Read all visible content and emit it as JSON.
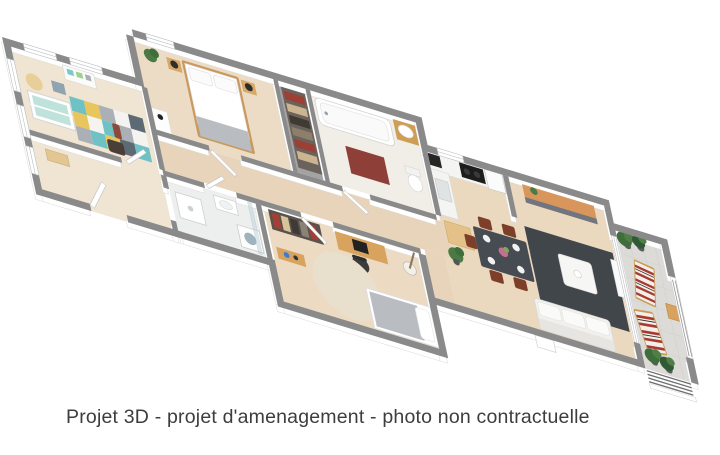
{
  "caption": {
    "text": "Projet 3D - projet d'amenagement - photo non contractuelle"
  },
  "palette": {
    "background": "#ffffff",
    "wall_top": "#8a8a8a",
    "wall_face": "#ffffff",
    "wood_floor": "#ead8bf",
    "wood_floor_light": "#f0e4d2",
    "terrace_tile": "#dcdbd7",
    "bath_tile": "#f1eee8",
    "closet_floor": "#a3a3a3",
    "accent_wood": "#d8a35f",
    "bed_wood": "#c9995e",
    "living_rug": "#41464b",
    "dining_table": "#474c52",
    "chair_brown": "#7e3f2a",
    "bath_mat_red": "#8e4038",
    "deck_stripe_red": "#a83a33",
    "kids_teal": "#6ec1c4",
    "kids_yellow": "#e9c55e",
    "plant_green": "#3f6d3c",
    "caption_text": "#3d3d3d"
  },
  "rooms": [
    "children-room",
    "entry-hall",
    "master-bedroom",
    "closet",
    "bathroom",
    "hallway",
    "shower-room",
    "bedroom-2",
    "kitchen",
    "dining-area",
    "living-room",
    "terrace"
  ]
}
